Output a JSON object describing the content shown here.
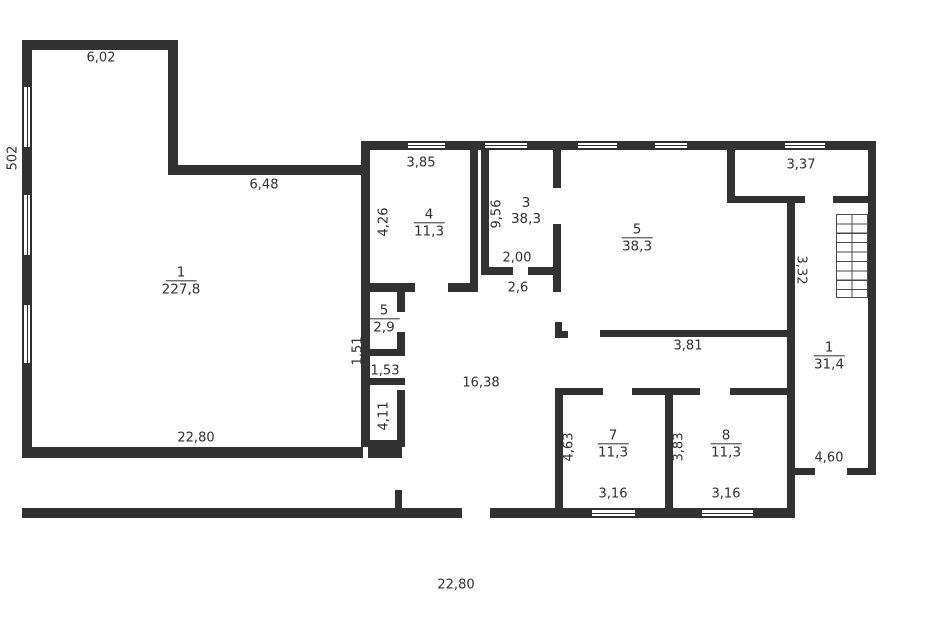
{
  "plan": {
    "colors": {
      "wall": "#323232",
      "background": "#ffffff",
      "text": "#2f2f2f"
    },
    "rooms": [
      {
        "id": "room-1-left",
        "number": "1",
        "area": "227,8"
      },
      {
        "id": "room-4",
        "number": "4",
        "area": "11,3"
      },
      {
        "id": "room-3",
        "number": "3",
        "area": "38,3"
      },
      {
        "id": "room-5-large",
        "number": "5",
        "area": "38,3"
      },
      {
        "id": "room-5-small",
        "number": "5",
        "area": "2,9"
      },
      {
        "id": "room-7",
        "number": "7",
        "area": "11,3"
      },
      {
        "id": "room-8",
        "number": "8",
        "area": "11,3"
      },
      {
        "id": "room-1-right",
        "number": "1",
        "area": "31,4"
      }
    ],
    "dimensions": {
      "d_602": "6,02",
      "d_502": "502",
      "d_648": "6,48",
      "d_385": "3,85",
      "d_426": "4,26",
      "d_956": "9,56",
      "d_200": "2,00",
      "d_26": "2,6",
      "d_337": "3,37",
      "d_332": "3,32",
      "d_381": "3,81",
      "d_1638": "16,38",
      "d_151": "1,51",
      "d_153": "1,53",
      "d_411": "4,11",
      "d_2280_top": "22,80",
      "d_463": "4,63",
      "d_383": "3,83",
      "d_316_a": "3,16",
      "d_316_b": "3,16",
      "d_460": "4,60",
      "d_2280_bottom": "22,80"
    }
  }
}
